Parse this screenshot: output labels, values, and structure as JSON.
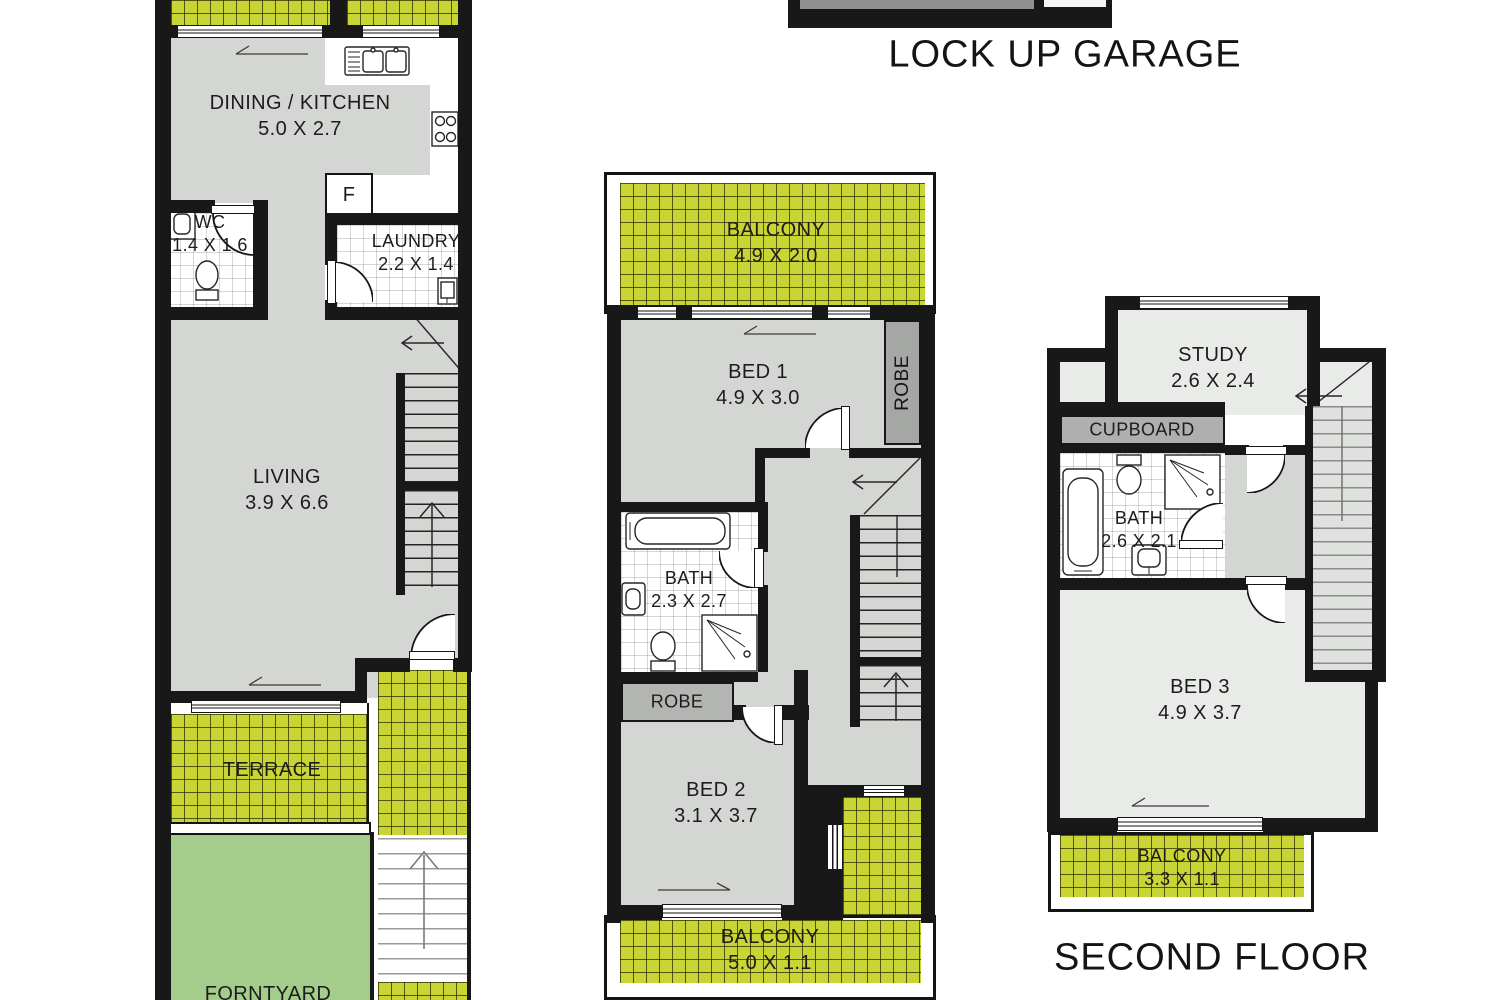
{
  "titles": {
    "garage": "LOCK UP GARAGE",
    "floor": "SECOND FLOOR"
  },
  "rooms": {
    "dining": {
      "name": "DINING  /  KITCHEN",
      "dims": "5.0 X 2.7"
    },
    "wc": {
      "name": "WC",
      "dims": "1.4 X 1.6"
    },
    "laundry": {
      "name": "LAUNDRY",
      "dims": "2.2 X 1.4"
    },
    "living": {
      "name": "LIVING",
      "dims": "3.9 X 6.6"
    },
    "terrace": {
      "name": "TERRACE"
    },
    "frontyard": {
      "name": "FORNTYARD"
    },
    "fridge": {
      "name": "F"
    },
    "balcony1": {
      "name": "BALCONY",
      "dims": "4.9 X 2.0"
    },
    "bed1": {
      "name": "BED 1",
      "dims": "4.9 X 3.0"
    },
    "robe1": {
      "name": "ROBE"
    },
    "bath1": {
      "name": "BATH",
      "dims": "2.3 X 2.7"
    },
    "robe2": {
      "name": "ROBE"
    },
    "bed2": {
      "name": "BED 2",
      "dims": "3.1 X 3.7"
    },
    "balcony2": {
      "name": "BALCONY",
      "dims": "5.0 X 1.1"
    },
    "study": {
      "name": "STUDY",
      "dims": "2.6 X 2.4"
    },
    "cupboard": {
      "name": "CUPBOARD"
    },
    "bath2": {
      "name": "BATH",
      "dims": "2.6 X 2.1"
    },
    "bed3": {
      "name": "BED 3",
      "dims": "4.9 X 3.7"
    },
    "balcony3": {
      "name": "BALCONY",
      "dims": "3.3 X 1.1"
    }
  },
  "colors": {
    "wall": "#181818",
    "floor_gray": "#d4d6d3",
    "floor_light": "#e9ebe8",
    "tile_green": "#c9d435",
    "yard_green": "#a4cc8b",
    "robe_gray": "#a5a7a4",
    "cupboard_gray": "#aeb0ad"
  }
}
